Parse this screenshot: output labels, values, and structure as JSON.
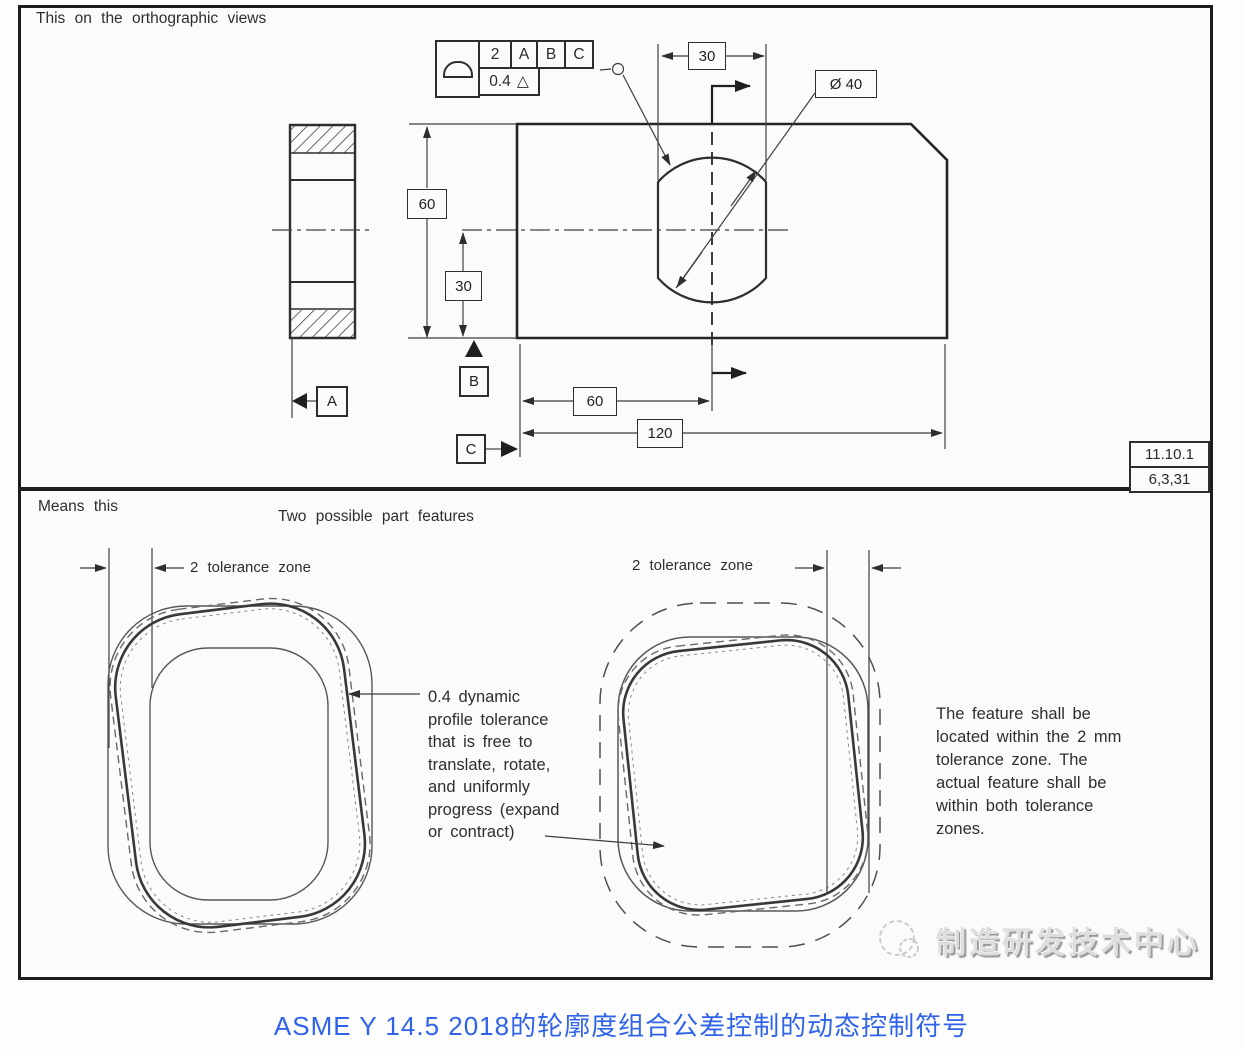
{
  "colors": {
    "line": "#2e2e2e",
    "panel_border": "#1d1d1d",
    "panel_bg": "#fbfbfb",
    "caption_blue": "#2f63ea",
    "watermark_gray": "#dedede"
  },
  "top_panel": {
    "title": "This on the orthographic views",
    "fcf": {
      "tolerance": "2",
      "datum_1": "A",
      "datum_2": "B",
      "datum_3": "C",
      "lower_tolerance": "0.4",
      "dynamic_symbol": "△"
    },
    "dims": {
      "width_top": "30",
      "diameter": "Ø 40",
      "height": "60",
      "center_offset": "30",
      "hole_location": "60",
      "total_width": "120"
    },
    "datums": {
      "a": "A",
      "b": "B",
      "c": "C"
    },
    "ref_box": {
      "line1": "11.10.1",
      "line2": "6,3,31"
    }
  },
  "bottom_panel": {
    "left_title": "Means this",
    "center_title": "Two possible part features",
    "left_zone_label": "2 tolerance zone",
    "right_zone_label": "2 tolerance zone",
    "left_note_lines": [
      "0.4 dynamic",
      "profile tolerance",
      "that is free to",
      "translate, rotate,",
      "and uniformly",
      "progress (expand",
      "or contract)"
    ],
    "right_note_lines": [
      "The feature shall be",
      "located within the 2 mm",
      "tolerance zone. The",
      "actual feature shall be",
      "within both tolerance",
      "zones."
    ],
    "watermark": "制造研发技术中心"
  },
  "caption": "ASME Y 14.5 2018的轮廓度组合公差控制的动态控制符号"
}
